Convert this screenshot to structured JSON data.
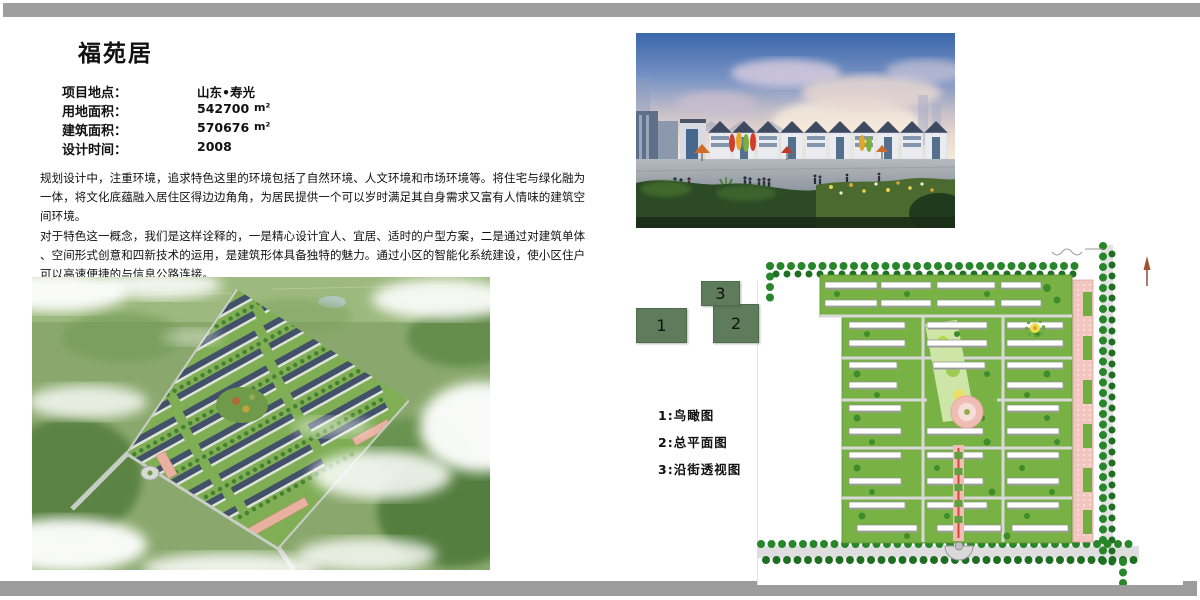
{
  "page": {
    "title": "福苑居",
    "info": {
      "rows": [
        {
          "label": "项目地点：",
          "value": "山东•寿光",
          "unit": ""
        },
        {
          "label": "用地面积：",
          "value": "542700",
          "unit": "m²"
        },
        {
          "label": "建筑面积：",
          "value": "570676",
          "unit": "m²"
        },
        {
          "label": "设计时间：",
          "value": "2008",
          "unit": ""
        }
      ]
    },
    "paragraphs": {
      "p1": [
        "规划设计中，注重环境，追求特色这里的环境包括了自然环境、人文环境和市场环境等。将住宅与绿化融为",
        "一体，将文化底蕴融入居住区得边边角角，为居民提供一个可以岁时满足其自身需求又富有人情味的建筑空",
        "间环境。"
      ],
      "p2": [
        "对于特色这一概念，我们是这样诠释的，一是精心设计宜人、宜居、适时的户型方案，二是通过对建筑单体",
        "、空间形式创意和四新技术的运用，是建筑形体具备独特的魅力。通过小区的智能化系统建设，使小区住户",
        "可以高速便捷的与信息公路连接。"
      ]
    },
    "figures": {
      "box1": "1",
      "box2": "2",
      "box3": "3"
    },
    "legend": {
      "items": [
        "1:鸟瞰图",
        "2:总平面图",
        "3:沿街透视图"
      ]
    },
    "colors": {
      "frame_gray": "#9e9e9e",
      "legend_box_green": "#5e7b5b"
    }
  }
}
